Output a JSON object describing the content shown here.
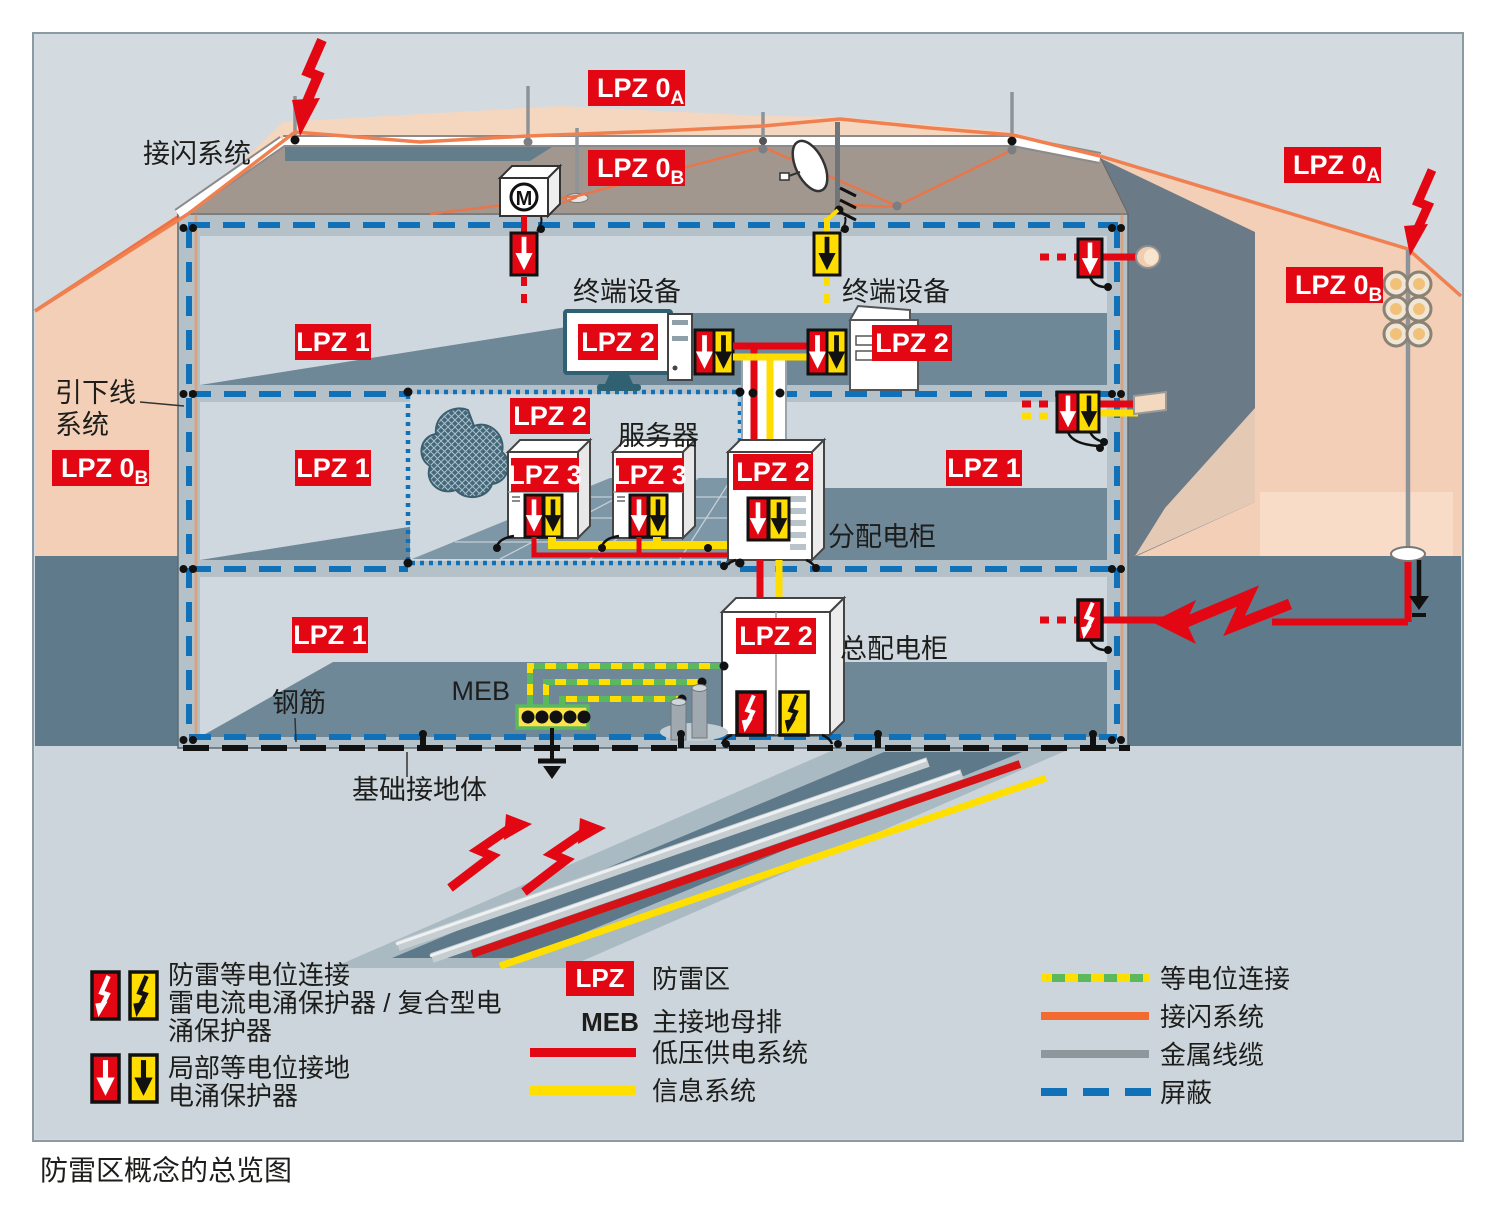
{
  "page": {
    "caption": "防雷区概念的总览图"
  },
  "badges": {
    "lpz": "LPZ",
    "lpz0": "LPZ 0",
    "sub_a": "A",
    "sub_b": "B",
    "lpz1": "LPZ 1",
    "lpz2": "LPZ 2",
    "lpz3": "LPZ 3"
  },
  "diagram": {
    "labels": {
      "air_termination_system": "接闪系统",
      "down_conductor_1": "引下线",
      "down_conductor_2": "系统",
      "terminal_equipment_left": "终端设备",
      "terminal_equipment_right": "终端设备",
      "server": "服务器",
      "distribution_cabinet": "分配电柜",
      "main_distribution_cabinet": "总配电柜",
      "rebar": "钢筋",
      "foundation_earth_electrode": "基础接地体",
      "meb": "MEB",
      "motor": "M"
    }
  },
  "legend": {
    "spd_lightning": {
      "line1": "防雷等电位连接",
      "line2": "雷电流电涌保护器 / 复合型电",
      "line3": "涌保护器"
    },
    "spd_local": {
      "line1": "局部等电位接地",
      "line2": "电涌保护器"
    },
    "lpz_zone_label": "防雷区",
    "meb_abbr": "MEB",
    "meb_label": "主接地母排",
    "lv_power": "低压供电系统",
    "it_system": "信息系统",
    "equipotential": "等电位连接",
    "air_termination": "接闪系统",
    "metal_cable": "金属线缆",
    "shielding": "屏蔽"
  },
  "colors": {
    "red": "#e30613",
    "yellow": "#ffdd00",
    "blue_shield": "#1070b8",
    "orange_air_termination": "#ee7044",
    "green_bonding": "#5cb85c",
    "gray_cable": "#8e979c",
    "peach_zone": "#f2cfb6",
    "panel_bg": "#d3dbe1"
  }
}
